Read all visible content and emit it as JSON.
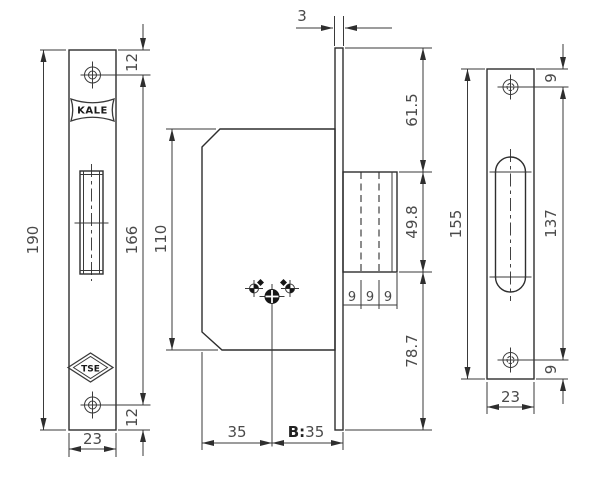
{
  "drawing": {
    "brand_logo": "KALE",
    "cert_logo": "TSE"
  },
  "dims": {
    "faceplate": {
      "total_height": "190",
      "screw_top_offset": "12",
      "screw_spacing": "166",
      "screw_bottom_offset": "12",
      "width": "23"
    },
    "case": {
      "height": "110",
      "backset": "35",
      "backset_prefix": "B:",
      "backset_value": "35"
    },
    "profile": {
      "faceplate_thickness": "3",
      "top_to_bolt": "61.5",
      "bolt_height": "49.8",
      "bolt_step_1": "9",
      "bolt_step_2": "9",
      "bolt_step_3": "9",
      "bolt_to_bottom": "78.7"
    },
    "strike": {
      "total_height": "155",
      "screw_top_offset": "9",
      "screw_spacing": "137",
      "screw_bottom_offset": "9",
      "width": "23"
    }
  }
}
